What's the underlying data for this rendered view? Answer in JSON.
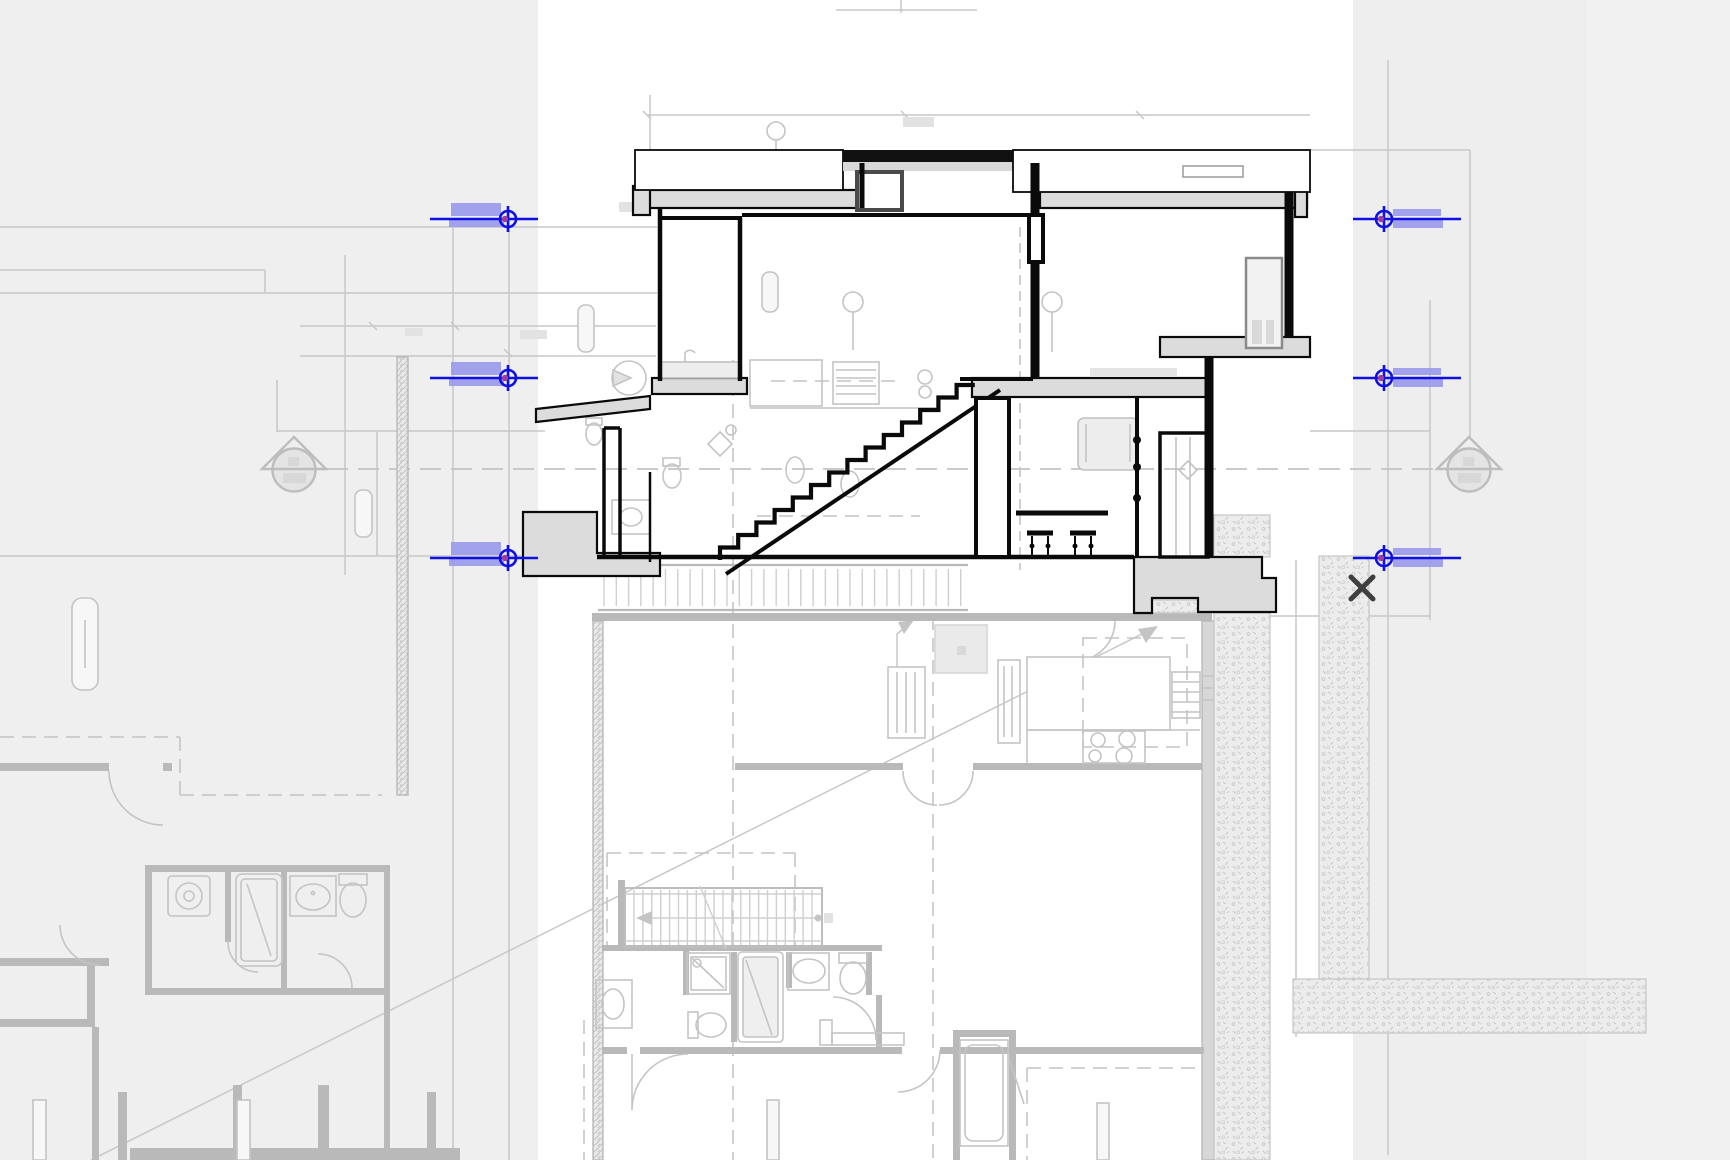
{
  "viewport": {
    "width": 1730,
    "height": 1160,
    "app_kind": "cad-section-and-plan-view",
    "visible_text": "none"
  },
  "colors": {
    "canvas_white": "#ffffff",
    "band_left": "#efefef",
    "band_right": "#eeeeee",
    "band_far_right": "#f1f1f1",
    "selection_blue": "#0f10e3",
    "selection_highlight": "#9a9aec",
    "grid_dot_purple": "#9c3f9c",
    "section_line": "#0a0a0a",
    "underlay_line": "#c7c7c7",
    "underlay_wall": "#b9b9b9",
    "slab_fill": "#dcdcdc",
    "close_mark": "#3f3f3f",
    "target_gray": "#bdbdbd",
    "textbox": "#e2e2e2"
  },
  "level_markers": {
    "rows": [
      {
        "y": 219
      },
      {
        "y": 378
      },
      {
        "y": 558
      }
    ],
    "left": {
      "x1": 430,
      "x2": 538,
      "cx": 508,
      "highlights": [
        {
          "x": 451,
          "dy": -16,
          "w": 50,
          "h": 13
        },
        {
          "x": 449,
          "dy": -1,
          "w": 55,
          "h": 9
        }
      ]
    },
    "right": {
      "x1": 1353,
      "x2": 1461,
      "cx": 1384,
      "highlights": [
        {
          "x": 1393,
          "dy": -10,
          "w": 48,
          "h": 7
        },
        {
          "x": 1393,
          "dy": 1,
          "w": 50,
          "h": 8
        }
      ]
    }
  },
  "elevation_targets": [
    {
      "cx": 294,
      "cy": 470
    },
    {
      "cx": 1469,
      "cy": 470
    }
  ],
  "close_mark": {
    "x": 1362,
    "y": 588,
    "size": 22
  },
  "icons": [
    {
      "name": "level-datum-icon",
      "glyph": "crosshair-circle",
      "count": 6
    },
    {
      "name": "elevation-target-icon",
      "glyph": "circle-with-triangle",
      "count": 2
    },
    {
      "name": "close-icon",
      "glyph": "x",
      "count": 1
    }
  ]
}
